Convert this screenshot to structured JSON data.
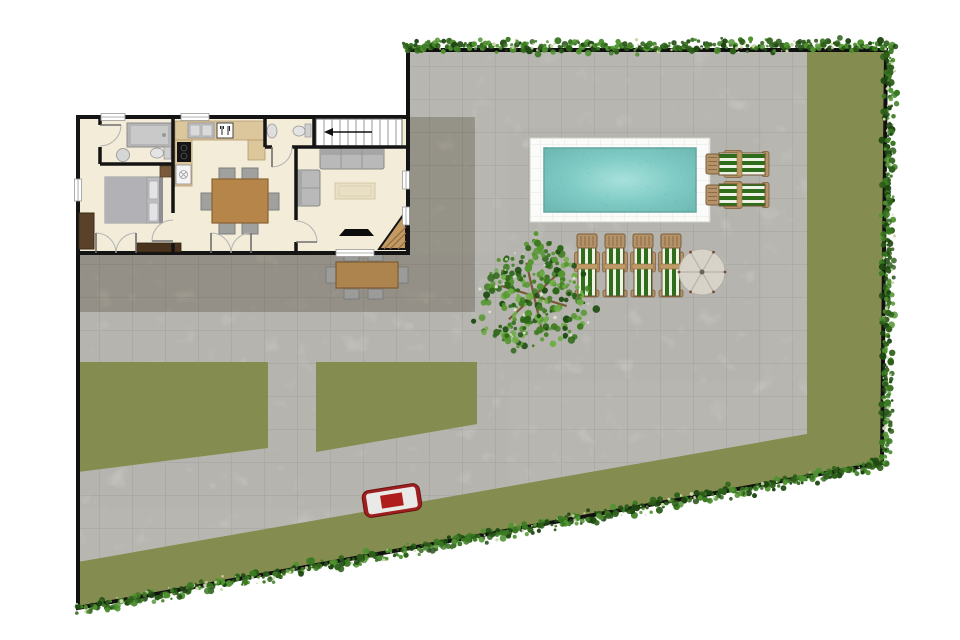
{
  "title": "Villa site plan - top view",
  "palette": {
    "background": "#ffffff",
    "boundary": "#101010",
    "pavement": "#deddd7",
    "pavement_grid": "#c7c6c0",
    "patio_dark": "#b6b1a6",
    "patio_dark_grid": "#a19c90",
    "grass": "#98a54c",
    "hedge_greens": [
      "#1e4712",
      "#2c5f18",
      "#3a7a22",
      "#4f9230",
      "#cdd8ad"
    ],
    "tree_greens": [
      "#1f4d12",
      "#2d6618",
      "#3f7d22",
      "#559630",
      "#6fae45"
    ],
    "tree_speckle": "#dde3cd",
    "tree_branch": "#7a5a36",
    "pool_deck": "#fbfbf9",
    "pool_water_center": "#86d6cf",
    "pool_water_mid": "#4eb7ae",
    "pool_water_edge": "#2d948c",
    "lounger_frame": "#b5936a",
    "lounger_stripe_green": "#2f6d1c",
    "lounger_stripe_white": "#edf2e4",
    "parasol": "#d8d3c9",
    "house_floor": "#f3ecd9",
    "wall": "#141414",
    "wood": "#b5854a",
    "counter_tan": "#dcc69c",
    "sofa_gray": "#b9b9b9",
    "bbq_red": "#a82222"
  },
  "site": {
    "areas": [
      "paved courtyard",
      "stone patio",
      "lawn right strip",
      "lawn bottom strip",
      "lawn patch left",
      "lawn patch middle"
    ],
    "hedge_sides": [
      "top",
      "right",
      "bottom"
    ]
  },
  "house": {
    "rooms": [
      {
        "name": "bedroom"
      },
      {
        "name": "bathroom"
      },
      {
        "name": "kitchen"
      },
      {
        "name": "dining area"
      },
      {
        "name": "wc"
      },
      {
        "name": "staircase"
      },
      {
        "name": "living room"
      }
    ],
    "furniture": [
      "double bed",
      "wardrobe",
      "shower",
      "toilet",
      "washbasin",
      "kitchen counter",
      "cooktop",
      "kitchen sink",
      "utensils sign",
      "dining table",
      "6 dining chairs",
      "sofa",
      "loveseat",
      "rug",
      "tv",
      "console"
    ]
  },
  "pool_area": {
    "pool": {
      "shape": "rectangle",
      "count": 1
    },
    "loungers_right": {
      "count": 2,
      "orientation": "horizontal"
    },
    "loungers_bottom": {
      "count": 4,
      "orientation": "vertical"
    },
    "parasol": {
      "count": 1
    },
    "shade_tree": {
      "count": 1
    }
  },
  "garden": {
    "bbq_grill": {
      "count": 1
    },
    "outdoor_dining": {
      "table": 1,
      "chairs": 6
    }
  }
}
